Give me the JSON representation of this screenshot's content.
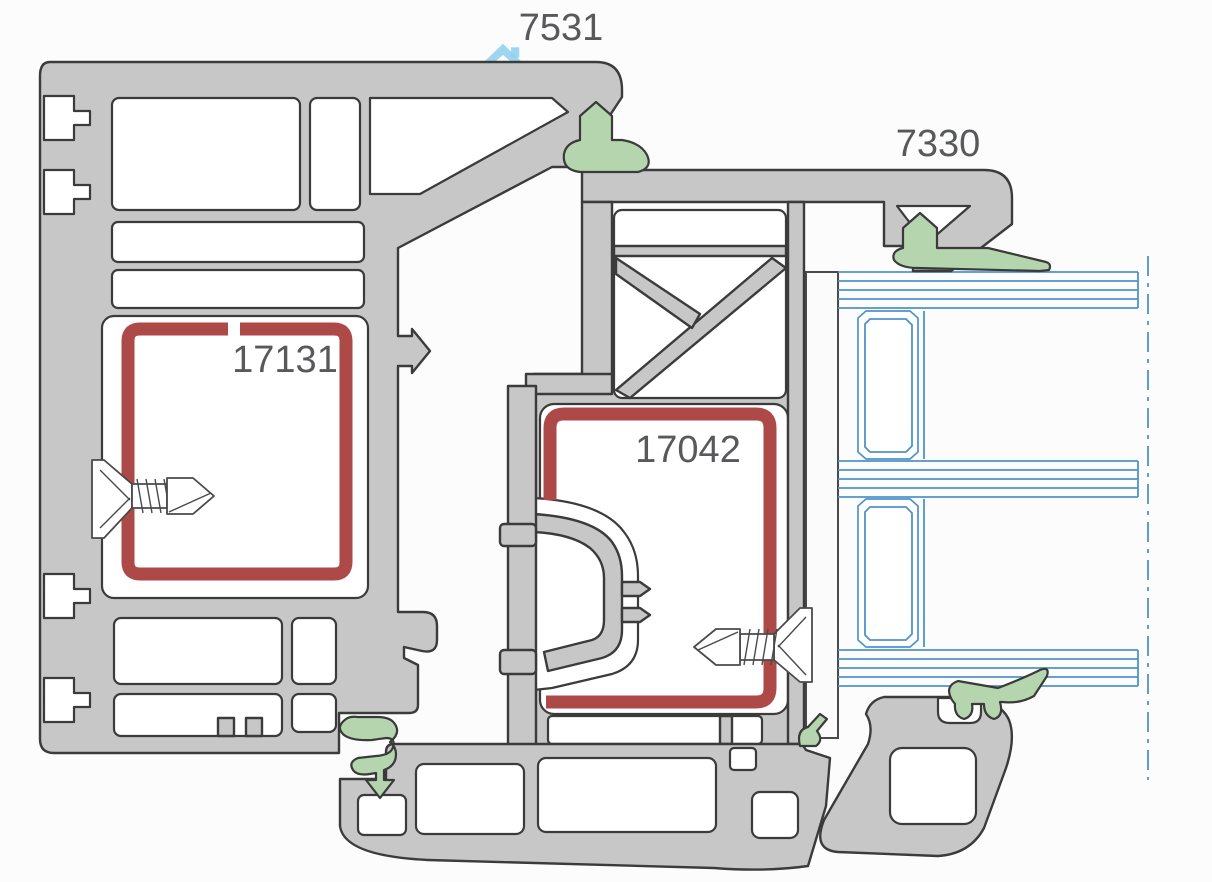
{
  "diagram": {
    "type": "window-profile-cross-section",
    "labels": {
      "frame_profile": "7531",
      "sash_profile": "7330",
      "frame_reinforcement": "17131",
      "sash_reinforcement": "17042"
    },
    "colors": {
      "background": "#fcfcfc",
      "profile_fill": "#c7c7c7",
      "profile_outline": "#3b3b3b",
      "chamber_fill": "#ffffff",
      "reinforcement_steel": "#ad4a48",
      "gasket_seal": "#b4d5ae",
      "glazing_line": "#4f93c9",
      "label_text": "#58595b",
      "watermark_blue": "#8ecfec",
      "watermark_pink": "#f0a8b0"
    },
    "parts": [
      {
        "id": "7531",
        "role": "outer-frame-profile"
      },
      {
        "id": "7330",
        "role": "sash-profile"
      },
      {
        "id": "17131",
        "role": "frame-steel-reinforcement"
      },
      {
        "id": "17042",
        "role": "sash-steel-reinforcement"
      }
    ]
  }
}
